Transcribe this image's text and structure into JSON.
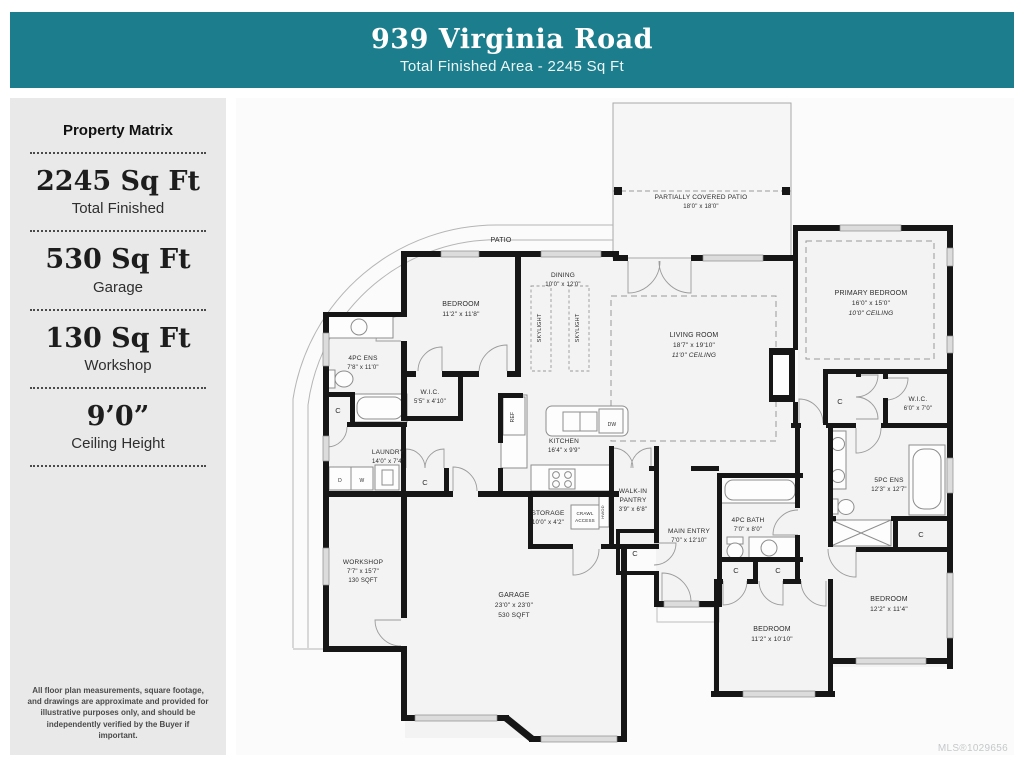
{
  "header": {
    "title": "939 Virginia Road",
    "subtitle": "Total Finished Area - 2245 Sq Ft"
  },
  "colors": {
    "accent": "#1C7D8C",
    "wall": "#161616"
  },
  "sidebar": {
    "heading": "Property Matrix",
    "stats": [
      {
        "value": "2245 Sq Ft",
        "label": "Total Finished"
      },
      {
        "value": "530 Sq Ft",
        "label": "Garage"
      },
      {
        "value": "130 Sq Ft",
        "label": "Workshop"
      },
      {
        "value": "9’0”",
        "label": "Ceiling Height"
      }
    ],
    "disclaimer": "All floor plan measurements, square footage, and drawings are approximate and provided for illustrative purposes only, and should be independently verified by the Buyer if important."
  },
  "footer": {
    "mls": "MLS®1029656"
  },
  "plan": {
    "labels": [
      {
        "x": 700,
        "y": 196,
        "t": "PARTIALLY COVERED PATIO",
        "s": 6.5
      },
      {
        "x": 700,
        "y": 205,
        "t": "18'0\" x 18'0\"",
        "s": 6
      },
      {
        "x": 500,
        "y": 239,
        "t": "PATIO",
        "s": 7
      },
      {
        "x": 460,
        "y": 303,
        "t": "BEDROOM",
        "s": 7
      },
      {
        "x": 460,
        "y": 313,
        "t": "11'2\" x 11'8\"",
        "s": 6.5
      },
      {
        "x": 362,
        "y": 357,
        "t": "4PC ENS",
        "s": 6.5
      },
      {
        "x": 362,
        "y": 366,
        "t": "7'8\" x 11'0\"",
        "s": 6
      },
      {
        "x": 429,
        "y": 391,
        "t": "W.I.C.",
        "s": 6.5
      },
      {
        "x": 429,
        "y": 400,
        "t": "5'5\" x 4'10\"",
        "s": 6
      },
      {
        "x": 337,
        "y": 410,
        "t": "C",
        "s": 7.5
      },
      {
        "x": 562,
        "y": 274,
        "t": "DINING",
        "s": 6.5
      },
      {
        "x": 562,
        "y": 283,
        "t": "10'0\" x 12'0\"",
        "s": 6
      },
      {
        "x": 540,
        "y": 325,
        "t": "SKYLIGHT",
        "s": 5.5,
        "r": -90
      },
      {
        "x": 578,
        "y": 325,
        "t": "SKYLIGHT",
        "s": 5.5,
        "r": -90
      },
      {
        "x": 693,
        "y": 334,
        "t": "LIVING ROOM",
        "s": 7
      },
      {
        "x": 693,
        "y": 344,
        "t": "18'7\" x 19'10\"",
        "s": 6.5
      },
      {
        "x": 693,
        "y": 354,
        "t": "11'0\" CEILING",
        "s": 6.5,
        "i": 1
      },
      {
        "x": 870,
        "y": 292,
        "t": "PRIMARY BEDROOM",
        "s": 7
      },
      {
        "x": 870,
        "y": 302,
        "t": "16'0\" x 15'0\"",
        "s": 6.5
      },
      {
        "x": 870,
        "y": 312,
        "t": "10'0\" CEILING",
        "s": 6.5,
        "i": 1
      },
      {
        "x": 839,
        "y": 401,
        "t": "C",
        "s": 7.5
      },
      {
        "x": 917,
        "y": 398,
        "t": "W.I.C.",
        "s": 6.5
      },
      {
        "x": 917,
        "y": 407,
        "t": "6'0\" x 7'0\"",
        "s": 6
      },
      {
        "x": 888,
        "y": 479,
        "t": "5PC ENS",
        "s": 6.5
      },
      {
        "x": 888,
        "y": 488,
        "t": "12'3\" x 12'7\"",
        "s": 6
      },
      {
        "x": 920,
        "y": 534,
        "t": "C",
        "s": 7.5
      },
      {
        "x": 888,
        "y": 598,
        "t": "BEDROOM",
        "s": 7
      },
      {
        "x": 888,
        "y": 608,
        "t": "12'2\" x 11'4\"",
        "s": 6.5
      },
      {
        "x": 771,
        "y": 628,
        "t": "BEDROOM",
        "s": 7
      },
      {
        "x": 771,
        "y": 638,
        "t": "11'2\" x 10'10\"",
        "s": 6.5
      },
      {
        "x": 735,
        "y": 570,
        "t": "C",
        "s": 7.5
      },
      {
        "x": 777,
        "y": 570,
        "t": "C",
        "s": 7.5
      },
      {
        "x": 747,
        "y": 519,
        "t": "4PC BATH",
        "s": 6.5
      },
      {
        "x": 747,
        "y": 528,
        "t": "7'0\" x 8'0\"",
        "s": 6
      },
      {
        "x": 688,
        "y": 530,
        "t": "MAIN ENTRY",
        "s": 6.5
      },
      {
        "x": 688,
        "y": 539,
        "t": "7'0\" x 12'10\"",
        "s": 6
      },
      {
        "x": 634,
        "y": 553,
        "t": "C",
        "s": 7.5
      },
      {
        "x": 632,
        "y": 490,
        "t": "WALK-IN",
        "s": 6.5
      },
      {
        "x": 632,
        "y": 499,
        "t": "PANTRY",
        "s": 6.5
      },
      {
        "x": 632,
        "y": 508,
        "t": "3'9\" x 6'8\"",
        "s": 6
      },
      {
        "x": 563,
        "y": 440,
        "t": "KITCHEN",
        "s": 6.5
      },
      {
        "x": 563,
        "y": 449,
        "t": "16'4\" x 9'9\"",
        "s": 6
      },
      {
        "x": 387,
        "y": 451,
        "t": "LAUNDRY",
        "s": 6.5
      },
      {
        "x": 387,
        "y": 460,
        "t": "14'0\" x 7'4\"",
        "s": 6
      },
      {
        "x": 424,
        "y": 482,
        "t": "C",
        "s": 7.5
      },
      {
        "x": 339,
        "y": 479,
        "t": "D",
        "s": 5
      },
      {
        "x": 361,
        "y": 479,
        "t": "W",
        "s": 5
      },
      {
        "x": 547,
        "y": 512,
        "t": "STORAGE",
        "s": 6.5
      },
      {
        "x": 547,
        "y": 521,
        "t": "10'0\" x 4'2\"",
        "s": 6
      },
      {
        "x": 584,
        "y": 512,
        "t": "CRAWL",
        "s": 4.5
      },
      {
        "x": 584,
        "y": 519,
        "t": "ACCESS",
        "s": 4.5
      },
      {
        "x": 603,
        "y": 509,
        "t": "HWOD",
        "s": 4,
        "r": -90
      },
      {
        "x": 513,
        "y": 414,
        "t": "REF",
        "s": 5,
        "r": -90
      },
      {
        "x": 611,
        "y": 423,
        "t": "DW",
        "s": 5
      },
      {
        "x": 362,
        "y": 561,
        "t": "WORKSHOP",
        "s": 6.5
      },
      {
        "x": 362,
        "y": 570,
        "t": "7'7\" x 15'7\"",
        "s": 6
      },
      {
        "x": 362,
        "y": 579,
        "t": "130 SQFT",
        "s": 6
      },
      {
        "x": 513,
        "y": 594,
        "t": "GARAGE",
        "s": 7
      },
      {
        "x": 513,
        "y": 604,
        "t": "23'0\" x 23'0\"",
        "s": 6.5
      },
      {
        "x": 513,
        "y": 614,
        "t": "530 SQFT",
        "s": 6.5
      }
    ]
  }
}
